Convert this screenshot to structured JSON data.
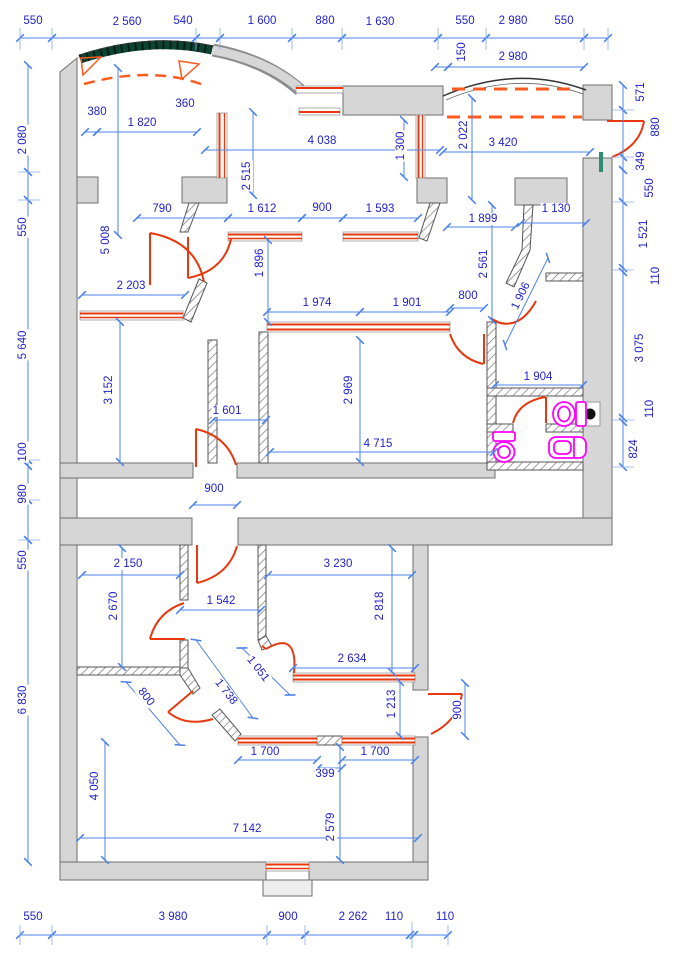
{
  "drawing_type": "architectural floor plan with dimension annotations",
  "colors": {
    "dimension_line": "#4d83e8",
    "dimension_text": "#2222cc",
    "wall_fill": "#d6d6d6",
    "wall_edge": "#6e6e6e",
    "door_window": "#e8380d",
    "dashed_opening": "#ff5a1e",
    "fixture": "#ff00ff",
    "balcony_glazing": "#0d4431",
    "glass": "#2e8b74"
  },
  "dims": {
    "top": [
      "550",
      "2 560",
      "540",
      "1 600",
      "880",
      "1 630",
      "550",
      "2 980",
      "550"
    ],
    "top2": [
      "150",
      "2 980"
    ],
    "left": [
      "2 080",
      "550",
      "5 640",
      "100",
      "980",
      "550",
      "6 830"
    ],
    "right": [
      "571",
      "880",
      "349",
      "550",
      "1 521",
      "110",
      "3 075",
      "110",
      "824"
    ],
    "bottom": [
      "550",
      "3 980",
      "900",
      "2 262",
      "110",
      "110"
    ],
    "interior": [
      "380",
      "360",
      "1 820",
      "4 038",
      "1 300",
      "2 022",
      "3 420",
      "2 515",
      "5 008",
      "790",
      "1 612",
      "900",
      "1 593",
      "1 899",
      "1 130",
      "2 561",
      "1 896",
      "2 203",
      "1 974",
      "1 901",
      "800",
      "1 906",
      "1 904",
      "2 969",
      "3 152",
      "1 601",
      "4 715",
      "900",
      "2 150",
      "3 230",
      "2 670",
      "1 542",
      "2 818",
      "1 051",
      "1 738",
      "800",
      "2 634",
      "1 213",
      "900",
      "1 700",
      "399",
      "1 700",
      "2 579",
      "7 142",
      "4 050"
    ]
  }
}
